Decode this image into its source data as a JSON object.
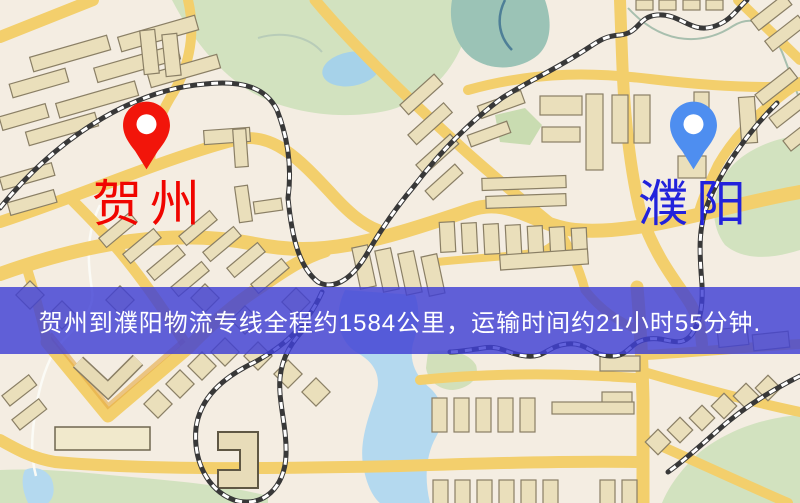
{
  "route_banner": {
    "text": "贺州到濮阳物流专线全程约1584公里，运输时间约21小时55分钟.",
    "distance_km": "1584",
    "transit_time": "21小时55分钟",
    "background_color": "#4040d4",
    "text_color": "#ffffff"
  },
  "origin_marker": {
    "label": "贺州",
    "pin_color": "#f2150a",
    "label_color": "#f00500"
  },
  "destination_marker": {
    "label": "濮阳",
    "pin_color": "#4e8ef0",
    "label_color": "#2222dc"
  },
  "map_colors": {
    "background": "#f3ede1",
    "road": "#f2cf6e",
    "railway": "#383838",
    "park": "#d2e2c0",
    "water": "#b5d9ee",
    "building": "#eadfbc"
  }
}
